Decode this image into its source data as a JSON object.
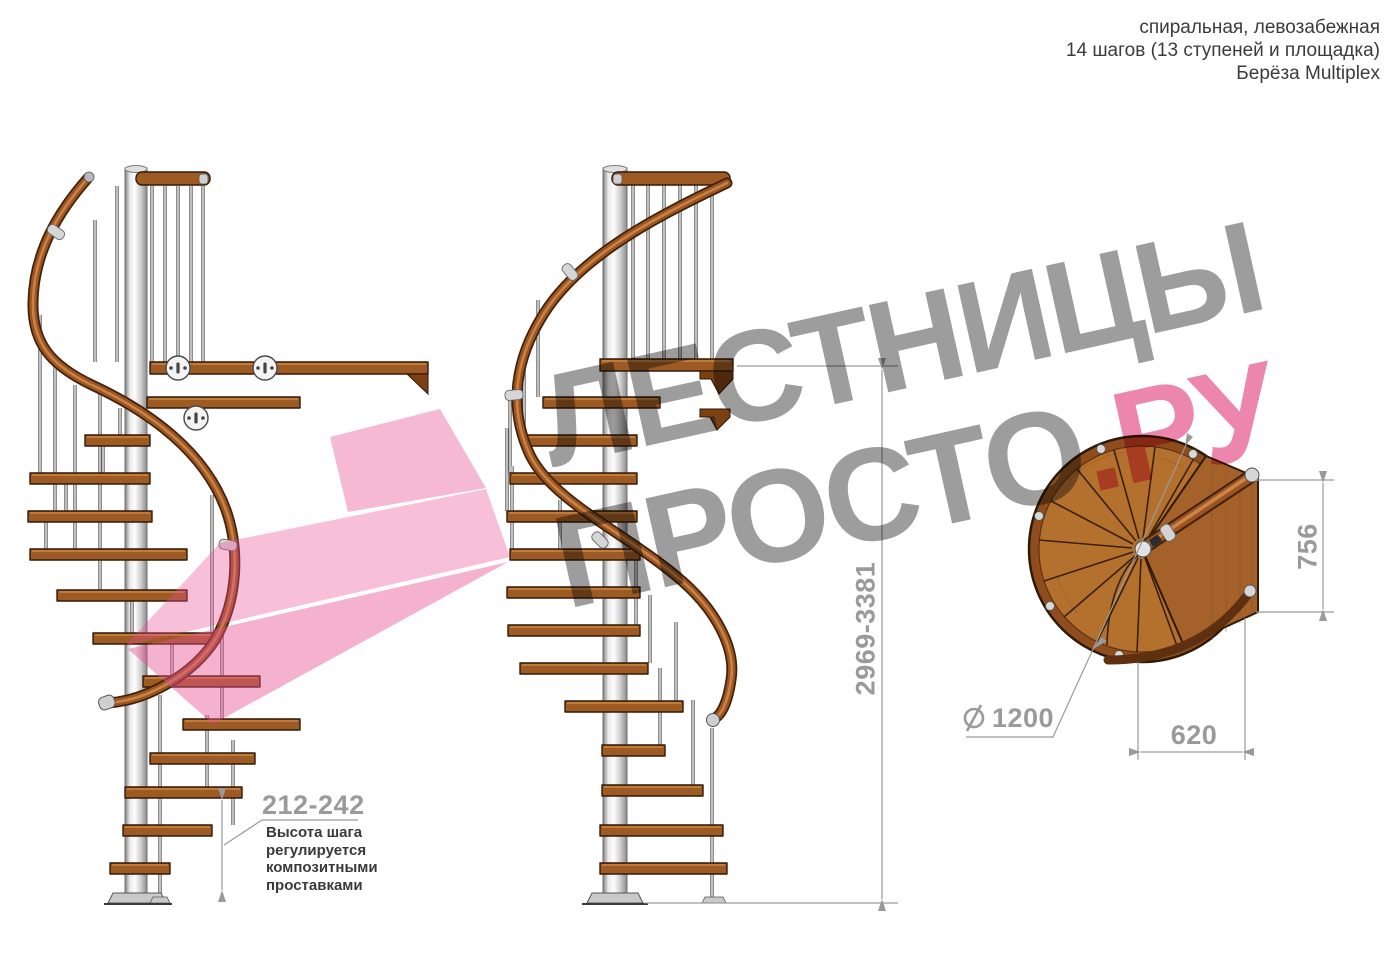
{
  "header": {
    "product_type": "спиральная, левозабежная",
    "steps_info": "14 шагов (13 ступеней и площадка)",
    "material": "Берёза Multiplex"
  },
  "watermark": {
    "word1": "ЛЕСТНИЦЫ",
    "word2": "ПРОСТО",
    "word2_suffix": ".РУ"
  },
  "dimensions": {
    "step_height_range": "212-242",
    "step_height_note": [
      "Высота шага",
      "регулируется",
      "композитными",
      "проставками"
    ],
    "total_height_range": "2969-3381",
    "landing_side": "756",
    "landing_width": "620",
    "diameter_symbol": "⌀",
    "diameter_value": "1200"
  },
  "colors": {
    "watermark_gray": "#9d9d9d",
    "watermark_pink": "#ec86ad",
    "logo_pink": "#e84f92",
    "dimension_gray": "#9a9a9a",
    "wood_brown": "#9d5a22",
    "plan_wood": "#b4712e",
    "pole_gray": "#cfcfcf",
    "note_text": "#3a3a3a"
  }
}
